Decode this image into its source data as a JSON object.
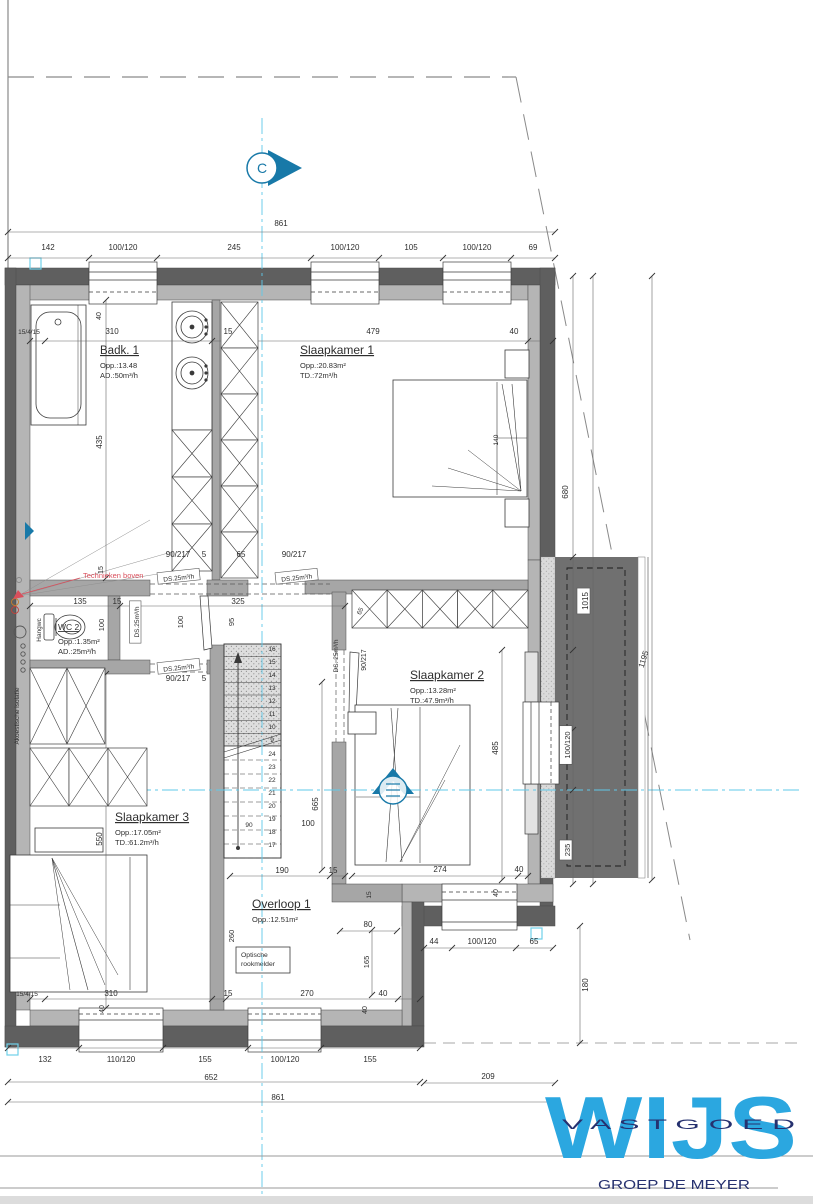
{
  "colors": {
    "wall_dark": "#5f5f5f",
    "wall_light": "#b5b5b5",
    "wall_inner": "#a6a6a6",
    "roof_dark": "#707070",
    "dim_text": "#2e2e2e",
    "centerline_cyan": "#5fc9e9",
    "marker_blue": "#1879a8",
    "note_red": "#d94f5c",
    "logo_blue": "#2ba7e0",
    "logo_navy": "#26316f"
  },
  "rooms": [
    {
      "id": "badk1",
      "name": "Badk. 1",
      "line1": "Opp.:13.48",
      "line2": "AD.:50m³/h",
      "x": 100,
      "y": 354,
      "ts": 11.5
    },
    {
      "id": "slaapkamer1",
      "name": "Slaapkamer 1",
      "line1": "Opp.:20.83m²",
      "line2": "TD.:72m³/h",
      "x": 300,
      "y": 354,
      "ts": 12
    },
    {
      "id": "wc2",
      "name": "WC 2",
      "line1": "Opp.:1.35m²",
      "line2": "AD.:25m³/h",
      "x": 58,
      "y": 630,
      "ts": 8.5
    },
    {
      "id": "slaapkamer2",
      "name": "Slaapkamer 2",
      "line1": "Opp.:13.28m²",
      "line2": "TD.:47.9m³/h",
      "x": 410,
      "y": 679,
      "ts": 12
    },
    {
      "id": "slaapkamer3",
      "name": "Slaapkamer 3",
      "line1": "Opp.:17.05m²",
      "line2": "TD.:61.2m³/h",
      "x": 115,
      "y": 821,
      "ts": 12
    },
    {
      "id": "overloop1",
      "name": "Overloop 1",
      "line1": "Opp.:12.51m²",
      "line2": "",
      "x": 252,
      "y": 908,
      "ts": 12
    }
  ],
  "annotations": [
    {
      "t": "861",
      "x": 281,
      "y": 226
    },
    {
      "t": "142",
      "x": 48,
      "y": 250
    },
    {
      "t": "100/120",
      "x": 123,
      "y": 250
    },
    {
      "t": "245",
      "x": 234,
      "y": 250
    },
    {
      "t": "100/120",
      "x": 345,
      "y": 250
    },
    {
      "t": "105",
      "x": 411,
      "y": 250
    },
    {
      "t": "100/120",
      "x": 477,
      "y": 250
    },
    {
      "t": "69",
      "x": 533,
      "y": 250
    },
    {
      "t": "15/4/15",
      "x": 29,
      "y": 334,
      "s": 6.5
    },
    {
      "t": "310",
      "x": 112,
      "y": 334
    },
    {
      "t": "15",
      "x": 228,
      "y": 334
    },
    {
      "t": "479",
      "x": 373,
      "y": 334
    },
    {
      "t": "40",
      "x": 514,
      "y": 334
    },
    {
      "t": "40",
      "x": 101,
      "y": 316,
      "r": -90,
      "s": 7
    },
    {
      "t": "435",
      "x": 102,
      "y": 442,
      "r": -90
    },
    {
      "t": "140",
      "x": 498,
      "y": 440,
      "r": -90,
      "s": 6.5
    },
    {
      "t": "90/217",
      "x": 178,
      "y": 557
    },
    {
      "t": "5",
      "x": 204,
      "y": 557
    },
    {
      "t": "65",
      "x": 241,
      "y": 557
    },
    {
      "t": "90/217",
      "x": 294,
      "y": 557
    },
    {
      "t": "DS.25m³/h",
      "x": 179,
      "y": 580,
      "r": -6,
      "s": 6.5,
      "b": 1
    },
    {
      "t": "DS.25m³/h",
      "x": 297,
      "y": 580,
      "r": -6,
      "s": 6.5,
      "b": 1
    },
    {
      "t": "15",
      "x": 103,
      "y": 570,
      "r": -90,
      "s": 7
    },
    {
      "t": "135",
      "x": 80,
      "y": 604
    },
    {
      "t": "15",
      "x": 117,
      "y": 604
    },
    {
      "t": "325",
      "x": 238,
      "y": 604
    },
    {
      "t": "100",
      "x": 104,
      "y": 625,
      "r": -90,
      "s": 7.5
    },
    {
      "t": "100",
      "x": 183,
      "y": 622,
      "r": -90,
      "s": 7.5
    },
    {
      "t": "95",
      "x": 234,
      "y": 622,
      "r": -90,
      "s": 7.5
    },
    {
      "t": "DS.25m³/h",
      "x": 139,
      "y": 622,
      "r": -90,
      "s": 6.5,
      "b": 1
    },
    {
      "t": "DS.25m³/h",
      "x": 179,
      "y": 670,
      "r": -6,
      "s": 6.5,
      "b": 1
    },
    {
      "t": "90/217",
      "x": 178,
      "y": 681
    },
    {
      "t": "5",
      "x": 204,
      "y": 681
    },
    {
      "t": "DS. 25m³/h",
      "x": 338,
      "y": 656,
      "r": -90,
      "s": 6.5
    },
    {
      "t": "90/217",
      "x": 366,
      "y": 660,
      "r": -90,
      "s": 7
    },
    {
      "t": "65",
      "x": 362,
      "y": 612,
      "r": -65,
      "s": 6.5
    },
    {
      "t": "665",
      "x": 318,
      "y": 804,
      "r": -90
    },
    {
      "t": "100",
      "x": 308,
      "y": 826
    },
    {
      "t": "90",
      "x": 249,
      "y": 827,
      "s": 6.5
    },
    {
      "t": "485",
      "x": 498,
      "y": 748,
      "r": -90
    },
    {
      "t": "274",
      "x": 440,
      "y": 872
    },
    {
      "t": "40",
      "x": 519,
      "y": 872
    },
    {
      "t": "40",
      "x": 498,
      "y": 893,
      "r": -90,
      "s": 7
    },
    {
      "t": "680",
      "x": 568,
      "y": 492,
      "r": -90
    },
    {
      "t": "1015",
      "x": 588,
      "y": 601,
      "r": -90,
      "b": 1
    },
    {
      "t": "1195",
      "x": 646,
      "y": 660,
      "r": -73
    },
    {
      "t": "100/120",
      "x": 570,
      "y": 745,
      "r": -90,
      "b": 1,
      "s": 7.5
    },
    {
      "t": "235",
      "x": 570,
      "y": 850,
      "r": -90,
      "b": 1,
      "s": 7.5
    },
    {
      "t": "15",
      "x": 371,
      "y": 895,
      "r": -90,
      "s": 6.5
    },
    {
      "t": "80",
      "x": 368,
      "y": 927
    },
    {
      "t": "165",
      "x": 369,
      "y": 962,
      "r": -90,
      "s": 7.5
    },
    {
      "t": "180",
      "x": 588,
      "y": 985,
      "r": -90
    },
    {
      "t": "44",
      "x": 434,
      "y": 944
    },
    {
      "t": "100/120",
      "x": 482,
      "y": 944
    },
    {
      "t": "65",
      "x": 534,
      "y": 944
    },
    {
      "t": "190",
      "x": 282,
      "y": 873
    },
    {
      "t": "15",
      "x": 333,
      "y": 873
    },
    {
      "t": "260",
      "x": 234,
      "y": 936,
      "r": -90,
      "s": 7.5
    },
    {
      "t": "550",
      "x": 102,
      "y": 839,
      "r": -90
    },
    {
      "t": "15/4/15",
      "x": 27,
      "y": 996,
      "s": 6.5
    },
    {
      "t": "310",
      "x": 111,
      "y": 996
    },
    {
      "t": "15",
      "x": 228,
      "y": 996
    },
    {
      "t": "270",
      "x": 307,
      "y": 996
    },
    {
      "t": "40",
      "x": 383,
      "y": 996
    },
    {
      "t": "40",
      "x": 104,
      "y": 1009,
      "r": -90,
      "s": 7
    },
    {
      "t": "40",
      "x": 367,
      "y": 1010,
      "r": -90,
      "s": 7
    },
    {
      "t": "132",
      "x": 45,
      "y": 1062
    },
    {
      "t": "110/120",
      "x": 121,
      "y": 1062
    },
    {
      "t": "155",
      "x": 205,
      "y": 1062
    },
    {
      "t": "100/120",
      "x": 285,
      "y": 1062
    },
    {
      "t": "155",
      "x": 370,
      "y": 1062
    },
    {
      "t": "652",
      "x": 211,
      "y": 1080
    },
    {
      "t": "209",
      "x": 488,
      "y": 1079
    },
    {
      "t": "861",
      "x": 278,
      "y": 1100
    },
    {
      "t": "Technieken boven",
      "x": 83,
      "y": 578,
      "c": "red",
      "s": 7.5,
      "a": "start"
    },
    {
      "t": "Akoestische isolatie",
      "x": 19,
      "y": 716,
      "r": -90,
      "s": 6.5
    },
    {
      "t": "Hangwc",
      "x": 41,
      "y": 630,
      "r": -90,
      "s": 6.5
    }
  ],
  "stairs": {
    "numbers_upper": [
      "16",
      "15",
      "14",
      "13",
      "12",
      "11",
      "10",
      "9"
    ],
    "numbers_lower": [
      "24",
      "23",
      "22",
      "21",
      "20",
      "19",
      "18",
      "17"
    ]
  },
  "markers": {
    "c": "C"
  },
  "smoke_detector": {
    "line1": "Optische",
    "line2": "rookmelder"
  },
  "logo": {
    "word": "WIJS",
    "sub": "V A S T G O E D",
    "tagline": "GROEP DE MEYER"
  }
}
